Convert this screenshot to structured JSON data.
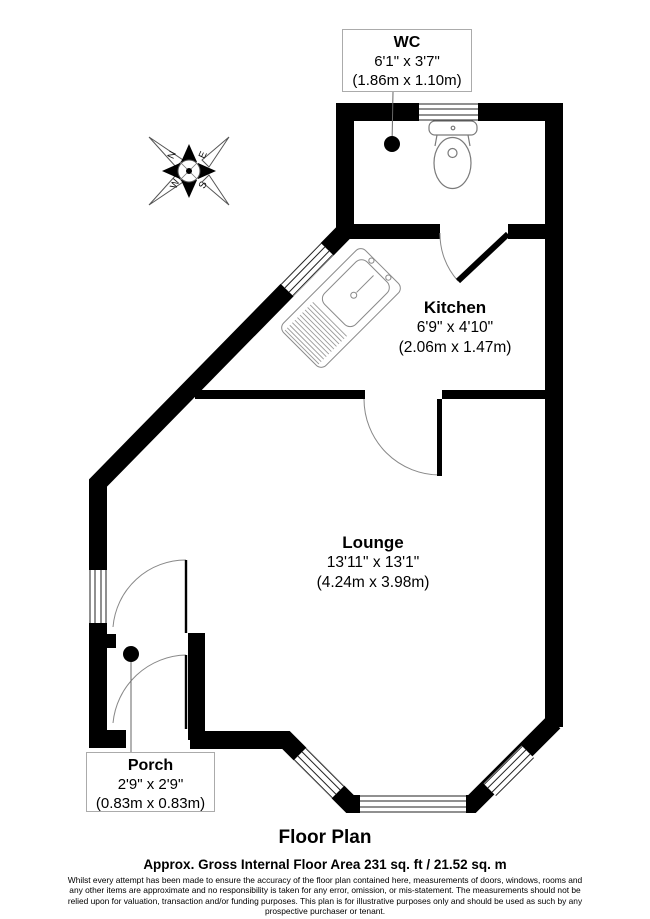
{
  "plan": {
    "title": "Floor Plan",
    "area_note": "Approx. Gross Internal Floor Area 231 sq. ft / 21.52 sq. m",
    "disclaimer": "Whilst every attempt has been made to ensure the accuracy of the floor plan contained here, measurements of doors, windows, rooms and any other items are approximate and no responsibility is taken for any error, omission, or mis-statement. The measurements should not be relied upon for valuation, transaction and/or funding purposes. This plan is for illustrative purposes only and should be used as such by any prospective purchaser or tenant."
  },
  "rooms": [
    {
      "name": "WC",
      "dims_imperial": "6'1\" x 3'7\"",
      "dims_metric": "(1.86m x 1.10m)"
    },
    {
      "name": "Kitchen",
      "dims_imperial": "6'9\" x 4'10\"",
      "dims_metric": "(2.06m x 1.47m)"
    },
    {
      "name": "Lounge",
      "dims_imperial": "13'11\" x 13'1\"",
      "dims_metric": "(4.24m x 3.98m)"
    },
    {
      "name": "Porch",
      "dims_imperial": "2'9\" x 2'9\"",
      "dims_metric": "(0.83m x 0.83m)"
    }
  ],
  "compass": {
    "north": "N",
    "east": "E",
    "south": "S",
    "west": "W"
  },
  "colors": {
    "wall": "#000000",
    "fixture_line": "#7a7a7a",
    "door_arc": "#888888",
    "leader_line": "#666666",
    "label_border": "#ababab",
    "background": "#ffffff"
  }
}
